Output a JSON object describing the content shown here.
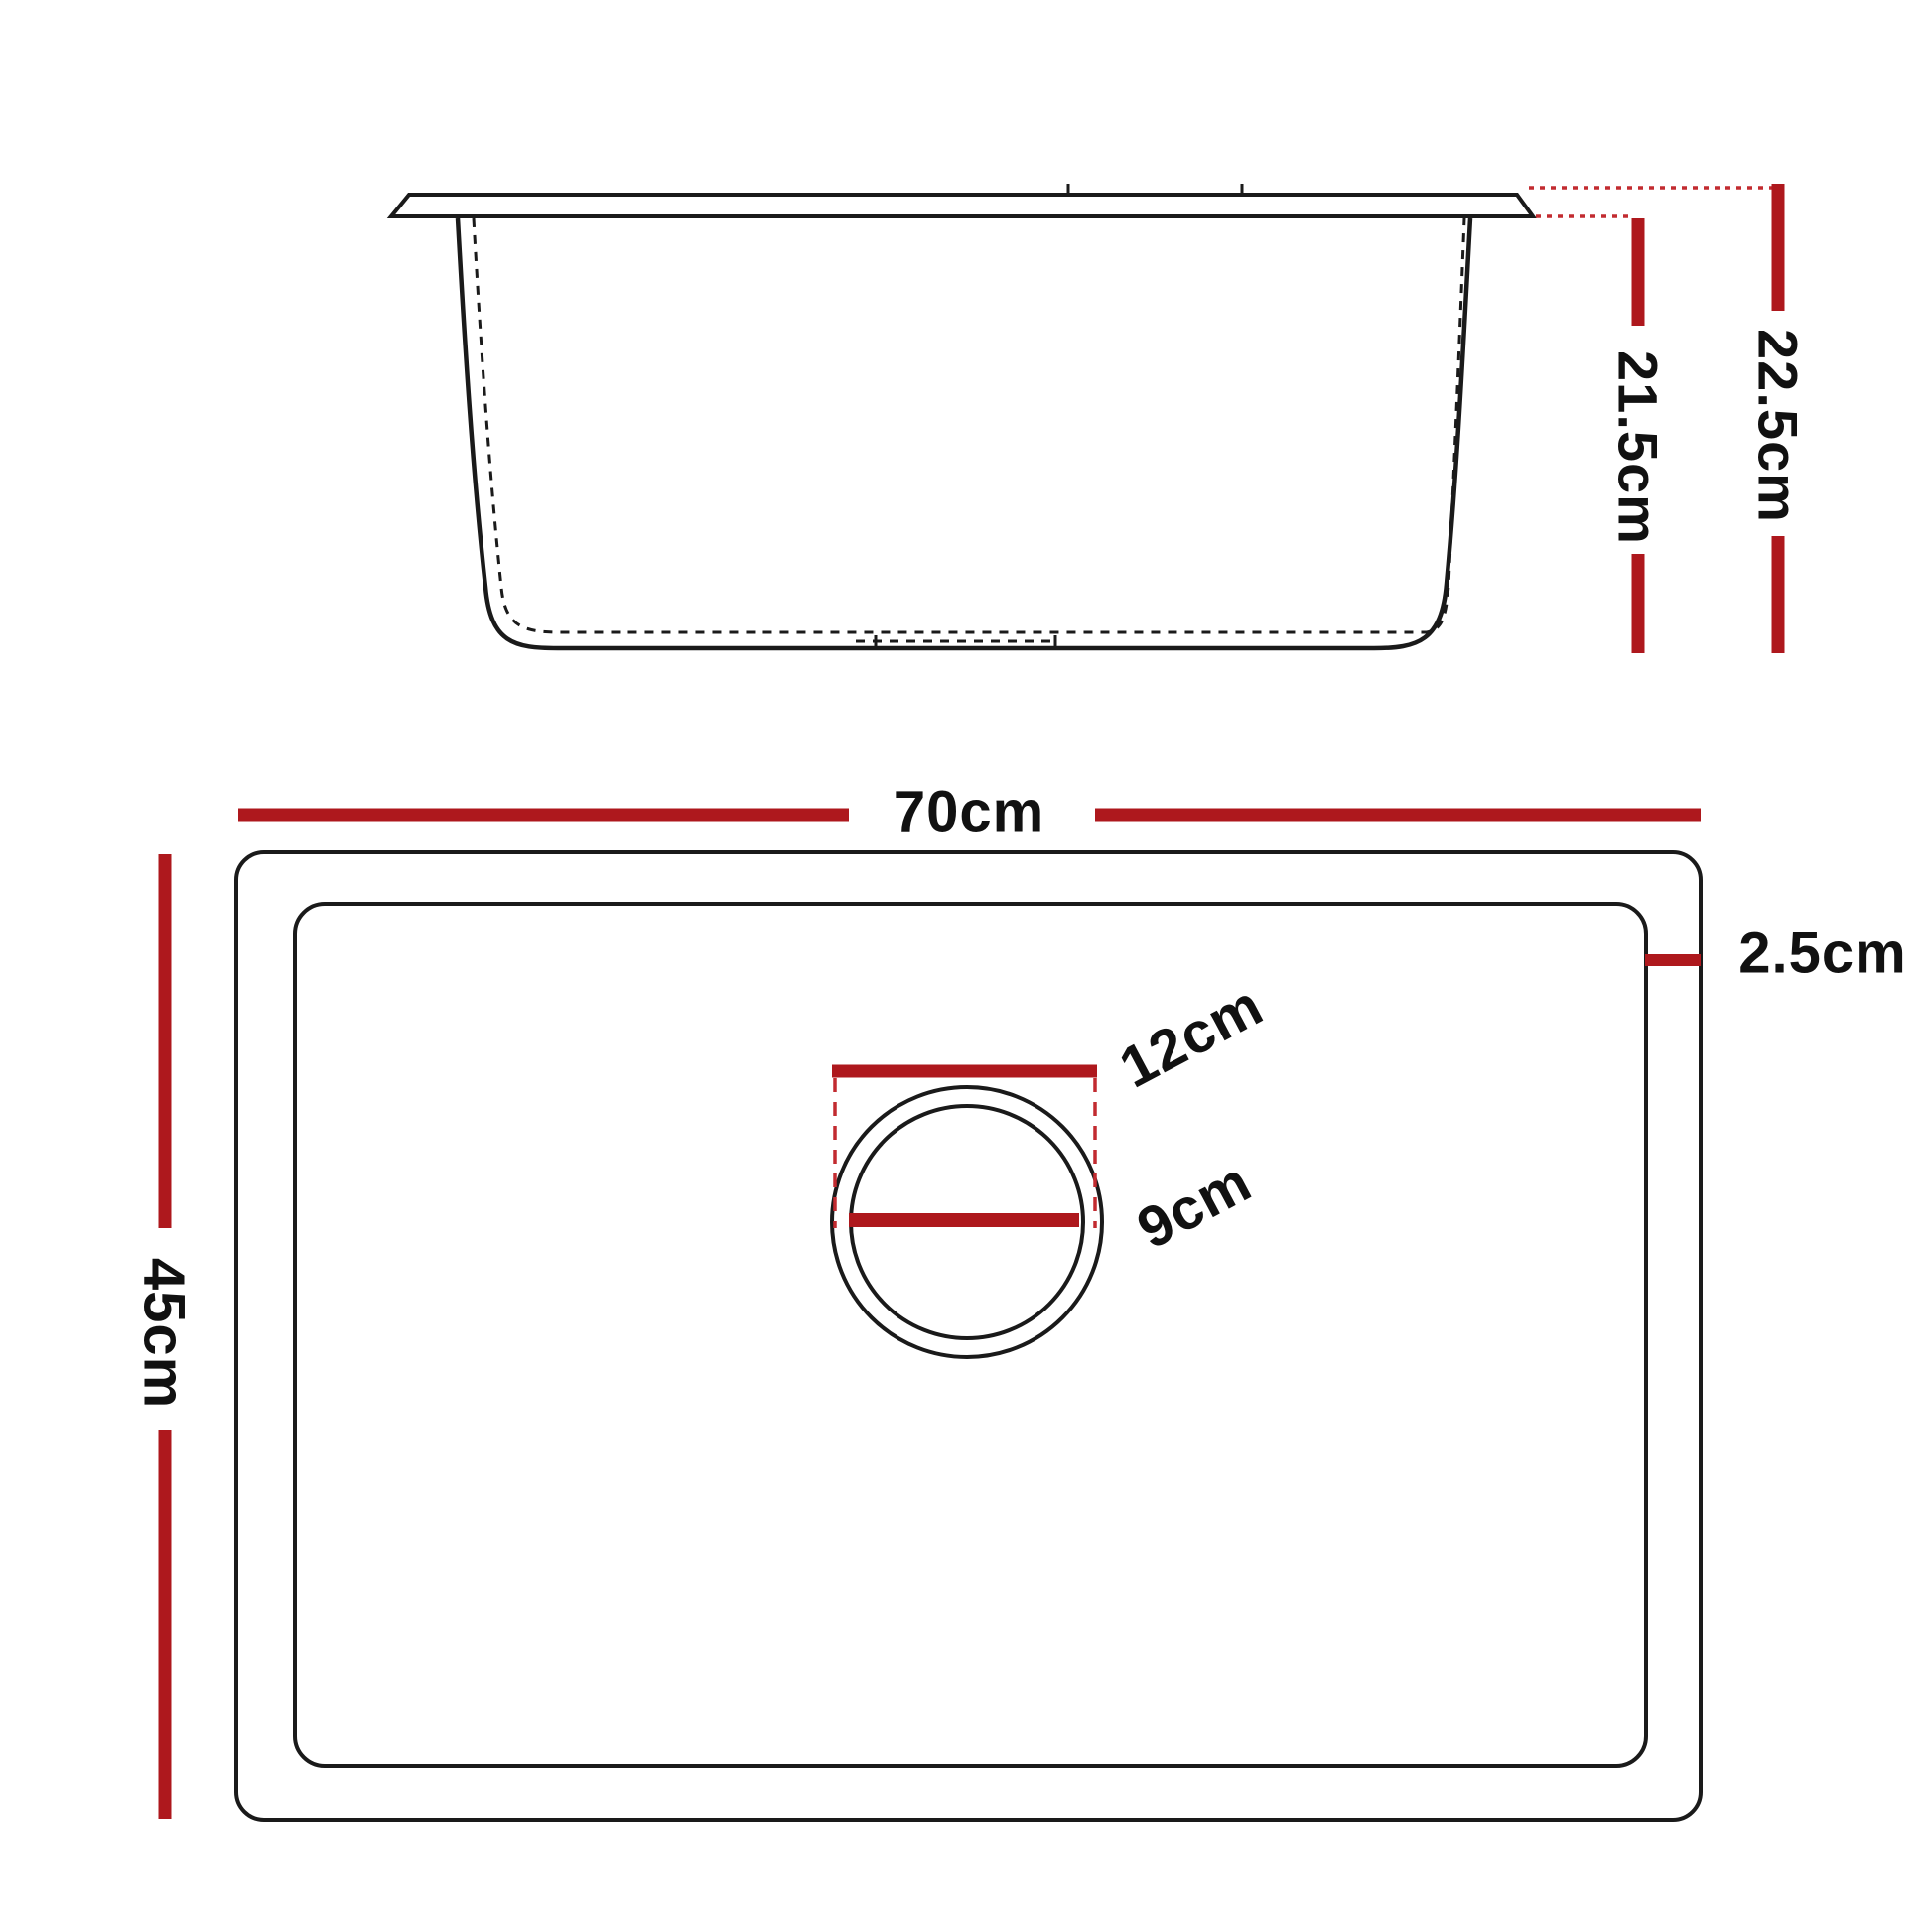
{
  "diagram": {
    "type": "sink-dimension-drawing",
    "side_view": {
      "labels": {
        "bowl_depth": "21.5cm",
        "total_depth": "22.5cm"
      }
    },
    "top_view": {
      "labels": {
        "overall_width": "70cm",
        "overall_depth": "45cm",
        "rim_width": "2.5cm",
        "drain_outer_diameter": "12cm",
        "drain_inner_diameter": "9cm"
      }
    }
  },
  "colors": {
    "red_solid": "#AE181D",
    "red_dashed": "#C22B30",
    "line_black": "#1A1A1A",
    "background": "#FFFFFF",
    "text": "#111111"
  }
}
